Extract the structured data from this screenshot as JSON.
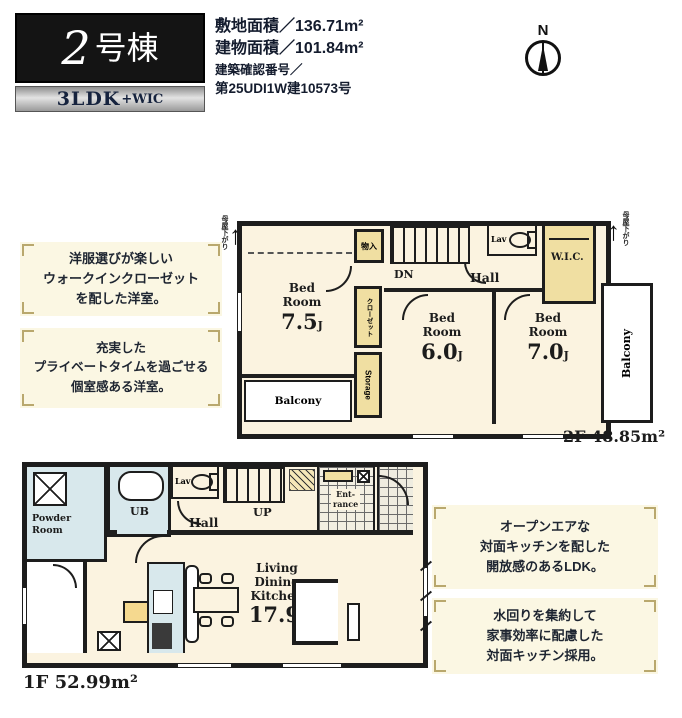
{
  "header": {
    "building_number": "2",
    "building_suffix": "号棟",
    "layout_main": "3LDK",
    "layout_plus": "+WIC",
    "site_area": "敷地面積／136.71m²",
    "building_area": "建物面積／101.84m²",
    "confirm_line1": "建築確認番号／",
    "confirm_line2": "第25UDI1W建10573号",
    "compass_n": "N"
  },
  "units": {
    "jo": "J"
  },
  "floor2": {
    "area_label": "2F 48.85m²",
    "moya_left": "母屋下がり",
    "moya_right": "母屋下がり",
    "bed1_name": "Bed Room",
    "bed1_size": "7.5",
    "bed2_name": "Bed Room",
    "bed2_size": "6.0",
    "bed3_name": "Bed Room",
    "bed3_size": "7.0",
    "dn": "DN",
    "hall": "Hall",
    "lav": "Lav",
    "wic": "W.I.C.",
    "storage_top": "物入",
    "closet": "クローゼット",
    "storage": "Storage",
    "balcony_bottom": "Balcony",
    "balcony_right": "Balcony"
  },
  "floor1": {
    "area_label": "1F 52.99m²",
    "powder_line1": "Powder",
    "powder_line2": "Room",
    "ub": "UB",
    "lav": "Lav",
    "hall": "Hall",
    "up": "UP",
    "entrance_line1": "Ent-",
    "entrance_line2": "rance",
    "ldk_line1": "Living",
    "ldk_line2": "Dining",
    "ldk_line3": "Kitchen",
    "ldk_size": "17.9"
  },
  "annotations": {
    "f2_box1": {
      "line1": "洋服選びが楽しい",
      "line2": "ウォークインクローゼット",
      "line3": "を配した洋室。"
    },
    "f2_box2": {
      "line1": "充実した",
      "line2": "プライベートタイムを過ごせる",
      "line3": "個室感ある洋室。"
    },
    "f1_box1": {
      "line1": "オープンエアな",
      "line2": "対面キッチンを配した",
      "line3": "開放感のあるLDK。"
    },
    "f1_box2": {
      "line1": "水回りを集約して",
      "line2": "家事効率に配慮した",
      "line3": "対面キッチン採用。"
    }
  },
  "colors": {
    "wall": "#1f1f1f",
    "room_cream": "#fbf3e0",
    "closet_yellow": "#f0dfa2",
    "water_blue": "#d8e8ec",
    "annotation_bg": "#fbf7e3",
    "bracket": "#b9a86d",
    "banner_black": "#141414"
  }
}
